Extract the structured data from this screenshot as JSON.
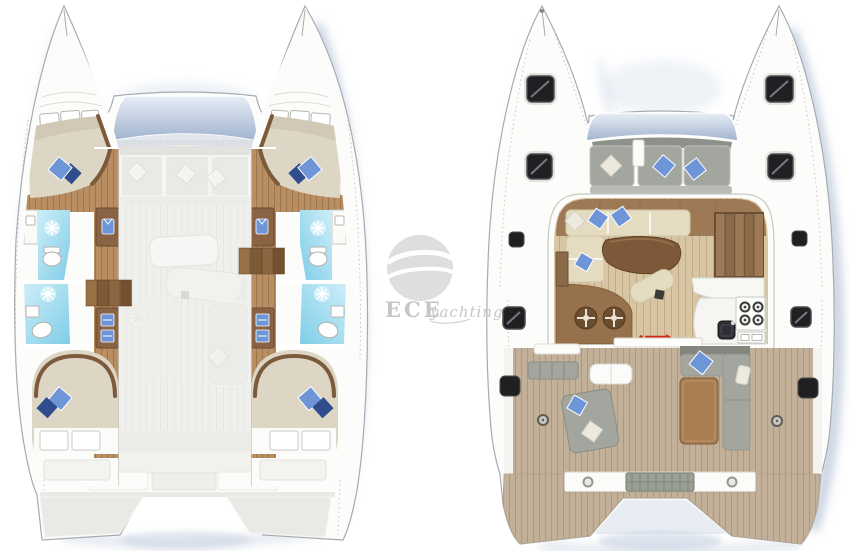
{
  "watermark": {
    "brand": "ECE",
    "suffix": "yachting"
  },
  "plans": [
    {
      "id": "lower-deck-plan",
      "side": "left",
      "features": [
        "forward-cabin",
        "forward-bathroom",
        "aft-bathroom",
        "aft-cabin",
        "wardrobe",
        "companionway-steps",
        "ghost-saloon",
        "ghost-cockpit",
        "swim-platforms"
      ]
    },
    {
      "id": "main-deck-plan",
      "side": "right",
      "features": [
        "foredeck-hatches",
        "forward-cockpit",
        "windshield",
        "saloon-sofa",
        "dining-table",
        "navigation-seats",
        "galley-stove",
        "galley-sink",
        "hull-stairs",
        "aft-cockpit",
        "cockpit-table",
        "transom-beam",
        "swim-platforms"
      ]
    }
  ],
  "colors": {
    "page_bg": "#ffffff",
    "hull_white": "#fcfcfa",
    "hull_line": "#a6abb3",
    "shadow_blue": "#8ba0bf",
    "glass_top": "#e9eef6",
    "glass_bottom": "#9fb2cd",
    "ghost": "#efefec",
    "ghost_line": "#e6e6e2",
    "ghost_dark": "#e2e2de",
    "wood": "#b98e62",
    "wood_line": "#9d754a",
    "trim_dark": "#7b5b3b",
    "wardrobe": "#8a6345",
    "mattress": "#ddd6c5",
    "mattress_shade": "#ccc3af",
    "bath_blue_light": "#cdeef8",
    "bath_blue_deep": "#7fcde8",
    "pillow_blue": "#6d95d8",
    "pillow_navy": "#2f4c8c",
    "pillow_white": "#eceadf",
    "salon_wood": "#d8c5a4",
    "salon_wood_line": "#c2aa83",
    "salon_band": "#9d7a55",
    "sofa_beige": "#e4dbc1",
    "table_brown": "#7d5939",
    "stair_brown": "#8a6a48",
    "galley_white": "#f6f5f1",
    "stove_black": "#3a3a38",
    "sink_dark": "#2e2e36",
    "red_accent": "#cf2a18",
    "cushion_gray": "#a3a69e",
    "cushion_gray_dark": "#83867e",
    "teak": "#c2b099",
    "teak_line": "#a9967e",
    "hatch_black": "#202023",
    "grate_gray": "#9aa096",
    "watermark_gray": "#dadada",
    "watermark_text": "#c6c6c6"
  }
}
